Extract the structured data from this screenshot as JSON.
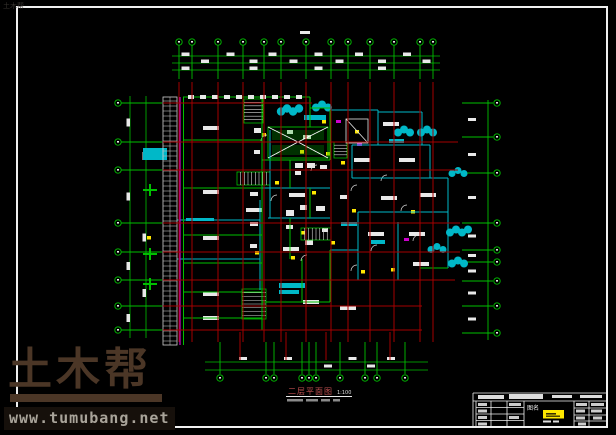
{
  "watermark": {
    "brand": "土木帮",
    "url": "www.tumubang.net"
  },
  "corner_watermark": {
    "brand": "土木帮"
  },
  "plan": {
    "title": "二层平面图",
    "scale": "1:100"
  },
  "title_block": {
    "name_label": "图名"
  },
  "colors": {
    "axis_green": "#00c000",
    "grid_red": "#a50000",
    "wall_cyan": "#00b8c8",
    "magenta": "#cc00cc",
    "highlight_yellow": "#ffe800",
    "line_white": "#e8e8e8",
    "watermark_brown": "#4b3626",
    "url_gray": "#a9a49a"
  }
}
